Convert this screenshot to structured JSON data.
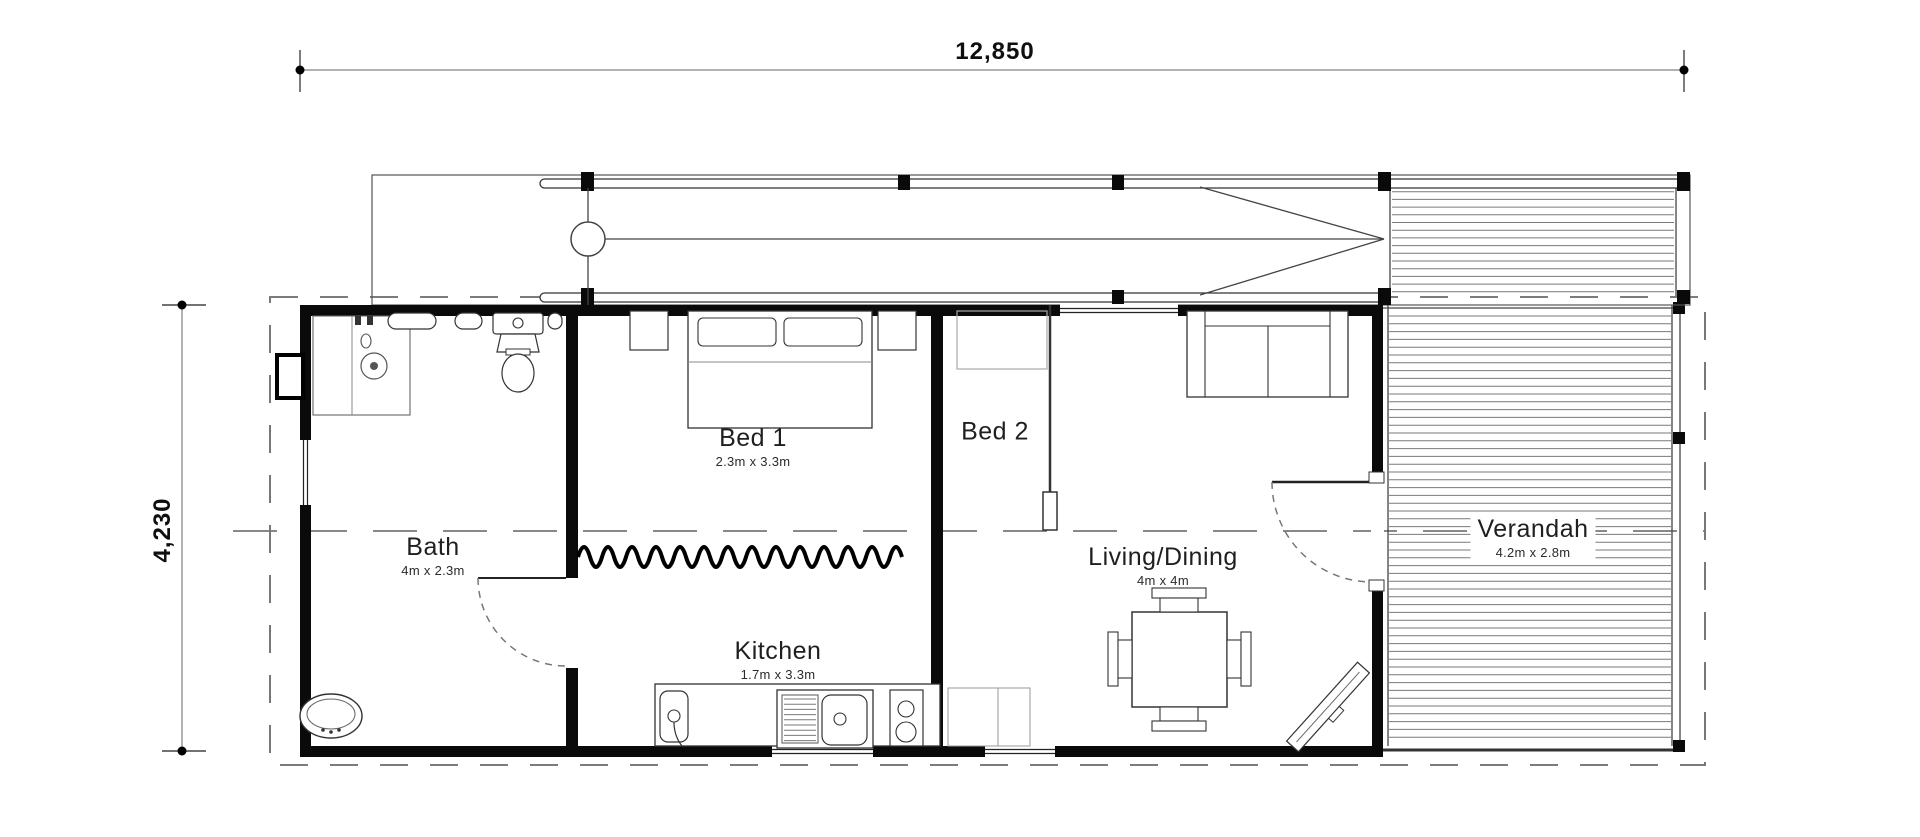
{
  "plan": {
    "overall_dimensions": {
      "width": "12,850",
      "height": "4,230"
    },
    "rooms": [
      {
        "id": "bath",
        "name": "Bath",
        "size": "4m x 2.3m"
      },
      {
        "id": "bed1",
        "name": "Bed 1",
        "size": "2.3m x 3.3m"
      },
      {
        "id": "bed2",
        "name": "Bed 2",
        "size": ""
      },
      {
        "id": "kitchen",
        "name": "Kitchen",
        "size": "1.7m x 3.3m"
      },
      {
        "id": "living",
        "name": "Living/Dining",
        "size": "4m x 4m"
      },
      {
        "id": "verandah",
        "name": "Verandah",
        "size": "4.2m x 2.8m"
      }
    ]
  }
}
